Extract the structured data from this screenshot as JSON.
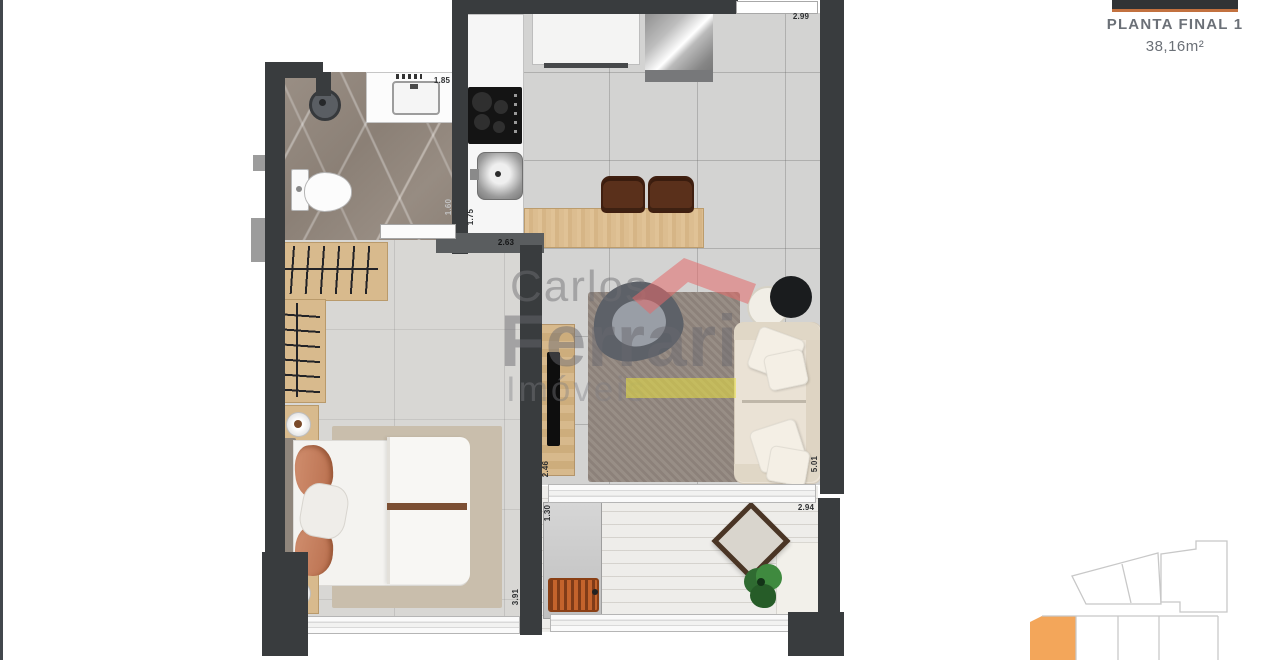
{
  "title_block": {
    "plan_name": "PLANTA FINAL 1",
    "plan_area": "38,16m²"
  },
  "watermark": {
    "line1": "Carlos",
    "line2": "Ferrari",
    "line3": "Imóveis"
  },
  "floor_plan": {
    "wall_color": "#393c3e",
    "measurements": [
      {
        "id": "vanity-width",
        "text": "1.85"
      },
      {
        "id": "kitchen-top-width",
        "text": "2.99"
      },
      {
        "id": "kitchen-length",
        "text": "1.75"
      },
      {
        "id": "bathroom-wall",
        "text": "1.60"
      },
      {
        "id": "hall-width",
        "text": "2.63"
      },
      {
        "id": "tv-wall-length",
        "text": "2.46"
      },
      {
        "id": "living-length",
        "text": "5.01"
      },
      {
        "id": "bedroom-length",
        "text": "3.91"
      },
      {
        "id": "balcony-depth",
        "text": "1.30"
      },
      {
        "id": "balcony-width",
        "text": "2.94"
      }
    ]
  },
  "key_plan": {
    "highlight_color": "#f3a65a",
    "outline_color": "#c8c8c8"
  },
  "accent_colors": {
    "title_underline": "#c2713f",
    "title_text": "#6b7077"
  }
}
